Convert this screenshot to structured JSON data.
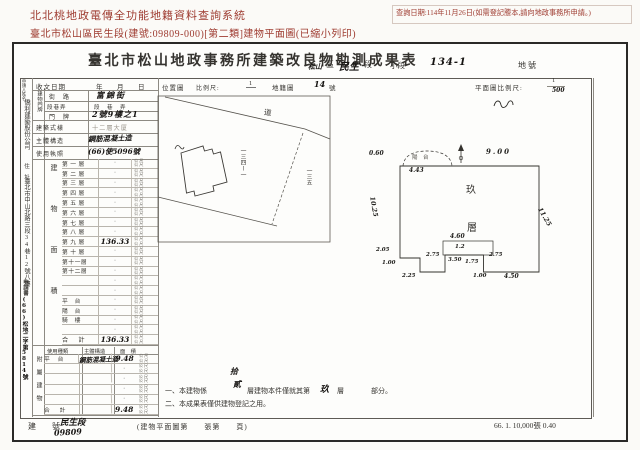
{
  "header": {
    "system_title": "北北桃地政電傳全功能地籍資料查詢系統",
    "query_date": "查詢日期:114年11月26日(如需登記謄本,請向地政事務所申請。)",
    "subtitle": "臺北市松山區民生段(建號:09809-000)[第二類]建物平面圖(已縮小列印)"
  },
  "doc": {
    "title": "臺北市松山地政事務所建築改良物勘測成果表",
    "land": {
      "district_hw": "松山",
      "district_label": "區",
      "section_hw": "民生",
      "section_label": "段",
      "subsection_label": "小段",
      "lot_hw": "134-1",
      "lot_label": "地號"
    },
    "row1": {
      "recv_label": "收文日期",
      "ymd": "年　月　日",
      "locmap_label": "位置圖",
      "scale_label": "比例尺:",
      "scale_num": "1",
      "cadmap_label": "地籍圖",
      "cad_no": "14",
      "cad_unit": "號",
      "planscale_label": "平面圖比例尺:",
      "plan_num": "1",
      "plan_den": "500"
    },
    "applicant": {
      "name_label": "申請人姓名",
      "name": "僑利建築股份公司",
      "addr_label": "住　址",
      "addr": "臺北市中山北路三段34巷12號八樓",
      "doc_label": "申請書",
      "doc_no": "(66)松地二字第5814號"
    },
    "bldg": {
      "door_label": "建物門牌",
      "street_label": "街　路",
      "street": "富錦街",
      "sec_label": "段巷弄",
      "sec_value": "段　巷　弄",
      "no_label": "門　牌",
      "no_value": "2號9樓之1",
      "style_label": "建築式樣",
      "style_value": "十二層大厦",
      "struct_label": "主體構造",
      "struct_value": "鋼筋混凝土造",
      "lic_label": "使用執照",
      "lic_value": "(66)使5096號"
    },
    "area_table": {
      "side": "建物面積",
      "unit": "公尺",
      "rows": [
        {
          "label": "第 一 層",
          "value": "·"
        },
        {
          "label": "第 二 層",
          "value": "·"
        },
        {
          "label": "第 三 層",
          "value": "·"
        },
        {
          "label": "第 四 層",
          "value": "·"
        },
        {
          "label": "第 五 層",
          "value": "·"
        },
        {
          "label": "第 六 層",
          "value": "·"
        },
        {
          "label": "第 七 層",
          "value": "·"
        },
        {
          "label": "第 八 層",
          "value": "·"
        },
        {
          "label": "第 九 層",
          "value": "136.33",
          "hw": true
        },
        {
          "label": "第 十 層",
          "value": "·"
        },
        {
          "label": "第十一層",
          "value": "·"
        },
        {
          "label": "第十二層",
          "value": "·"
        },
        {
          "label": "",
          "value": "·"
        },
        {
          "label": "",
          "value": "·"
        },
        {
          "label": "平　台",
          "value": "·"
        },
        {
          "label": "陽　台",
          "value": "·"
        },
        {
          "label": "騎　樓",
          "value": "·"
        },
        {
          "label": "",
          "value": "·"
        }
      ],
      "total_label": "合　計",
      "total_value": "136.33"
    },
    "annex": {
      "side": "附屬建物",
      "use_h": "使用種類",
      "struct_h": "主體構造",
      "area_h": "面　積",
      "unit": "公尺",
      "rows": [
        {
          "use": "平　台",
          "struct": "鋼筋混凝土造",
          "area": "9.48",
          "hw": true
        },
        {
          "use": "",
          "struct": "",
          "area": "·"
        },
        {
          "use": "",
          "struct": "",
          "area": "·"
        },
        {
          "use": "",
          "struct": "",
          "area": "·"
        },
        {
          "use": "",
          "struct": "",
          "area": "·"
        }
      ],
      "total_label": "合　計",
      "total_value": "9.48"
    },
    "locmap": {
      "road": "道",
      "parcel": "一三四ー一",
      "neighbor": "一三五"
    },
    "plan": {
      "balcony": "陽　台",
      "d_443": "4.43",
      "d_060": "0.60",
      "d_900": "9.00",
      "d_1025": "10.25",
      "d_1125": "11.25",
      "floor1": "玖",
      "floor2": "層",
      "d_460": "4.60",
      "d_12": "1.2",
      "d_275l": "2.75",
      "d_350": "3.50",
      "d_175": "1.75",
      "d_275r": "2.75",
      "d_205": "2.05",
      "d_100l": "1.00",
      "d_225": "2.25",
      "d_100b": "1.00",
      "d_450": "4.50"
    },
    "notes": {
      "n1a": "一、本建物係",
      "n1_hw1": "拾",
      "n1_hw2": "貳",
      "n1b": "層建物本件僅就其第",
      "n1_hw3": "玖",
      "n1c": "層",
      "n1d": "部分。",
      "n2": "二、本成果表僅供建物登記之用。"
    },
    "footer": {
      "bno_label": "建　號",
      "bno_hw1": "民生段",
      "bno_hw2": "09809",
      "page_note": "(建物平面圖第　　張第　　頁)",
      "print_note": "66. 1. 10,000張 0.40"
    }
  }
}
